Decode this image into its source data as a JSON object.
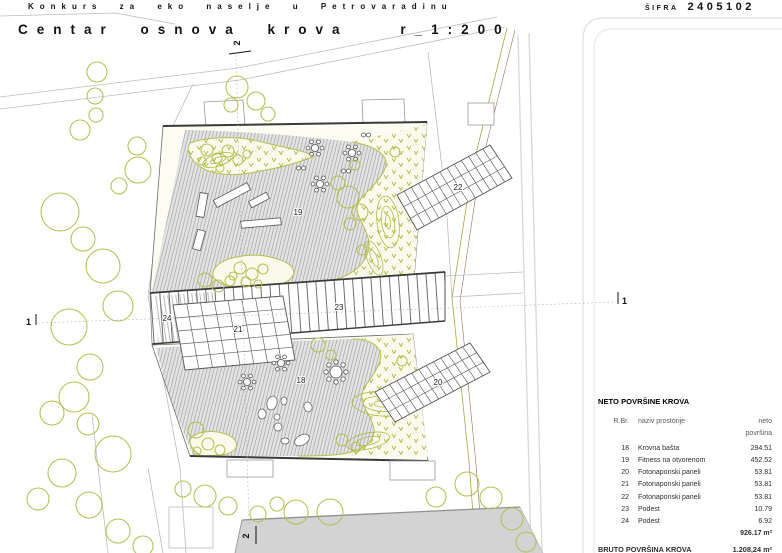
{
  "header": {
    "competition_title": "Konkurs za eko naselje u Petrovaradinu",
    "code_label": "ŠIFRA",
    "code_value": "2405102",
    "drawing_title": "Centar osnova krova",
    "drawing_scale": "r_1:200"
  },
  "plan": {
    "labels": {
      "a18": "18",
      "a19": "19",
      "a20": "20",
      "a21": "21",
      "a22": "22",
      "a23": "23",
      "a24": "24"
    },
    "sections": {
      "s1": "1",
      "s2": "2"
    },
    "colors": {
      "vegetation": "#b5c04f",
      "hatch_line": "#9c9c9c",
      "planted_fill": "#fafaec",
      "road_fill": "#d3d3d3",
      "dark_line": "#3a3a3a",
      "site_line": "#bcbcbc"
    }
  },
  "table": {
    "title": "NETO POVRŠINE KROVA",
    "columns": {
      "num": "R.Br.",
      "name": "naziv prostorije",
      "area": "neto površina"
    },
    "rows": [
      {
        "num": "18",
        "name": "Krovna bašta",
        "area": "294.51"
      },
      {
        "num": "19",
        "name": "Fitness na otvorenom",
        "area": "452.52"
      },
      {
        "num": "20",
        "name": "Fotonaponski paneli",
        "area": "53.81"
      },
      {
        "num": "21",
        "name": "Fotonaponski paneli",
        "area": "53.81"
      },
      {
        "num": "22",
        "name": "Fotonaponski paneli",
        "area": "53.81"
      },
      {
        "num": "23",
        "name": "Podest",
        "area": "10.79"
      },
      {
        "num": "24",
        "name": "Podest",
        "area": "6.92"
      }
    ],
    "total_neto": "926.17 m²",
    "bruto_label": "BRUTO POVRŠINA KROVA",
    "bruto_value": "1.208,24 m²"
  }
}
